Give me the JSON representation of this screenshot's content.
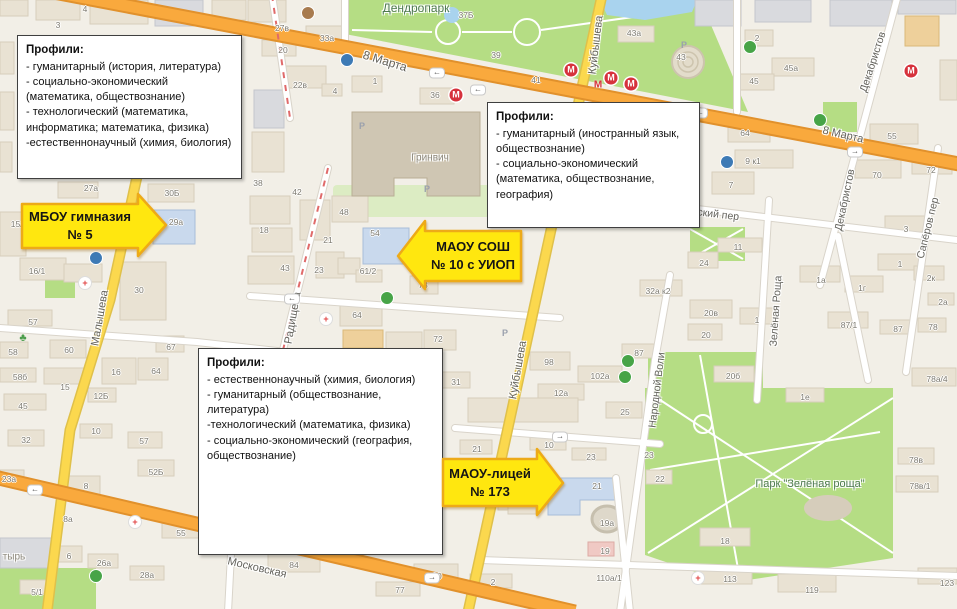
{
  "colors": {
    "map_background": "#f2efe7",
    "road_main": "#f9a93d",
    "road_main_casing": "#e1912c",
    "road_secondary": "#fbd84e",
    "road_secondary_casing": "#dfc04a",
    "road_minor": "#ffffff",
    "road_minor_casing": "#d9d4ca",
    "park_green": "#b5dd84",
    "water_blue": "#a9d3ee",
    "building_fill": "#e9e2d3",
    "building_dark": "#cfc6b3",
    "school_blue": "#c9d9ed",
    "annotation_yellow": "#ffe70f",
    "annotation_border": "#edaa18",
    "callout_border": "#3f3f3f",
    "metro_red": "#d6323c"
  },
  "callouts": [
    {
      "title": "Профили:",
      "items": [
        "- гуманитарный (история, литература)",
        "- социально-экономический (математика, обществознание)",
        "- технологический (математика, информатика; математика, физика)",
        "-естественнонаучный (химия, биология)"
      ]
    },
    {
      "title": "Профили:",
      "items": [
        "- гуманитарный (иностранный язык, обществознание)",
        "- социально-экономический (математика, обществознание, география)"
      ]
    },
    {
      "title": "Профили:",
      "items": [
        "- естественнонаучный  (химия, биология)",
        "- гуманитарный (обществознание, литература)",
        "-технологический (математика, физика)",
        "- социально-экономический (география, обществознание)"
      ]
    }
  ],
  "school_labels": [
    {
      "line1": "МБОУ гимназия",
      "line2": "№ 5",
      "arrow_direction": "right"
    },
    {
      "line1": "МАОУ СОШ",
      "line2": "№ 10 с УИОП",
      "arrow_direction": "left"
    },
    {
      "line1": "МАОУ-лицей",
      "line2": "№ 173",
      "arrow_direction": "right"
    }
  ],
  "map": {
    "street_labels": [
      {
        "t": "8 Марта",
        "x": 385,
        "y": 61,
        "rot": 17,
        "size": 12
      },
      {
        "t": "8 Марта",
        "x": 843,
        "y": 135,
        "rot": 13,
        "size": 11
      },
      {
        "t": "Московская",
        "x": 257,
        "y": 568,
        "rot": 13,
        "size": 11
      },
      {
        "t": "Куйбышева",
        "x": 596,
        "y": 45,
        "rot": -83,
        "size": 11
      },
      {
        "t": "Куйбышева",
        "x": 518,
        "y": 370,
        "rot": -80,
        "size": 11
      },
      {
        "t": "Малышева",
        "x": 100,
        "y": 318,
        "rot": -80,
        "size": 11
      },
      {
        "t": "Радищева",
        "x": 293,
        "y": 318,
        "rot": -80,
        "size": 11
      },
      {
        "t": "Народной Воли",
        "x": 657,
        "y": 390,
        "rot": -83,
        "size": 10.5
      },
      {
        "t": "Зелёная Роща",
        "x": 776,
        "y": 311,
        "rot": -86,
        "size": 10.5
      },
      {
        "t": "Сапёров пер",
        "x": 928,
        "y": 228,
        "rot": -76,
        "size": 10.5
      },
      {
        "t": "Декабристов",
        "x": 873,
        "y": 62,
        "rot": -72,
        "size": 10.5
      },
      {
        "t": "Декабристов",
        "x": 845,
        "y": 200,
        "rot": -78,
        "size": 10.5
      },
      {
        "t": "Университетский пер",
        "x": 688,
        "y": 211,
        "rot": 7,
        "size": 10.5
      }
    ],
    "place_labels": [
      {
        "t": "Дендропарк",
        "x": 416,
        "y": 8,
        "size": 12,
        "k": "park"
      },
      {
        "t": "Парк \"Зелёная роща\"",
        "x": 810,
        "y": 484,
        "size": 11,
        "k": "park"
      },
      {
        "t": "Гринвич",
        "x": 430,
        "y": 158,
        "size": 10,
        "k": "bldg"
      },
      {
        "t": "тырь",
        "x": 14,
        "y": 557,
        "size": 10,
        "k": "bldg"
      }
    ],
    "building_labels": [
      {
        "t": "4",
        "x": 85,
        "y": 9
      },
      {
        "t": "3",
        "x": 58,
        "y": 25
      },
      {
        "t": "27в",
        "x": 282,
        "y": 28
      },
      {
        "t": "33а",
        "x": 327,
        "y": 38
      },
      {
        "t": "20",
        "x": 283,
        "y": 50
      },
      {
        "t": "22в",
        "x": 300,
        "y": 85
      },
      {
        "t": "4",
        "x": 335,
        "y": 91
      },
      {
        "t": "1",
        "x": 375,
        "y": 81
      },
      {
        "t": "36",
        "x": 435,
        "y": 95
      },
      {
        "t": "37Б",
        "x": 466,
        "y": 15
      },
      {
        "t": "39",
        "x": 496,
        "y": 55
      },
      {
        "t": "41",
        "x": 536,
        "y": 80
      },
      {
        "t": "43а",
        "x": 634,
        "y": 33
      },
      {
        "t": "43",
        "x": 681,
        "y": 57
      },
      {
        "t": "2",
        "x": 757,
        "y": 38
      },
      {
        "t": "45а",
        "x": 791,
        "y": 68
      },
      {
        "t": "45",
        "x": 754,
        "y": 81
      },
      {
        "t": "64",
        "x": 745,
        "y": 133
      },
      {
        "t": "55",
        "x": 892,
        "y": 136
      },
      {
        "t": "9 к1",
        "x": 753,
        "y": 161
      },
      {
        "t": "7",
        "x": 731,
        "y": 185
      },
      {
        "t": "70",
        "x": 877,
        "y": 175
      },
      {
        "t": "72",
        "x": 931,
        "y": 170
      },
      {
        "t": "3",
        "x": 906,
        "y": 229
      },
      {
        "t": "1",
        "x": 900,
        "y": 264
      },
      {
        "t": "11",
        "x": 738,
        "y": 247
      },
      {
        "t": "24",
        "x": 704,
        "y": 263
      },
      {
        "t": "32а к2",
        "x": 658,
        "y": 291
      },
      {
        "t": "20в",
        "x": 711,
        "y": 313
      },
      {
        "t": "20",
        "x": 706,
        "y": 335
      },
      {
        "t": "1",
        "x": 757,
        "y": 320
      },
      {
        "t": "1а",
        "x": 821,
        "y": 280
      },
      {
        "t": "1г",
        "x": 862,
        "y": 288
      },
      {
        "t": "87/1",
        "x": 849,
        "y": 325
      },
      {
        "t": "87",
        "x": 898,
        "y": 329
      },
      {
        "t": "78",
        "x": 933,
        "y": 327
      },
      {
        "t": "2к",
        "x": 931,
        "y": 278
      },
      {
        "t": "2а",
        "x": 943,
        "y": 302
      },
      {
        "t": "38",
        "x": 258,
        "y": 183
      },
      {
        "t": "42",
        "x": 297,
        "y": 192
      },
      {
        "t": "48",
        "x": 344,
        "y": 212
      },
      {
        "t": "18",
        "x": 264,
        "y": 230
      },
      {
        "t": "21",
        "x": 328,
        "y": 240
      },
      {
        "t": "43",
        "x": 285,
        "y": 268
      },
      {
        "t": "23",
        "x": 319,
        "y": 270
      },
      {
        "t": "54",
        "x": 375,
        "y": 233
      },
      {
        "t": "61/2",
        "x": 368,
        "y": 271
      },
      {
        "t": "73",
        "x": 423,
        "y": 285
      },
      {
        "t": "64",
        "x": 357,
        "y": 315
      },
      {
        "t": "72",
        "x": 438,
        "y": 339
      },
      {
        "t": "27а",
        "x": 91,
        "y": 188
      },
      {
        "t": "30Б",
        "x": 172,
        "y": 193
      },
      {
        "t": "29а",
        "x": 176,
        "y": 222
      },
      {
        "t": "15/2",
        "x": 19,
        "y": 224
      },
      {
        "t": "16/1",
        "x": 37,
        "y": 271
      },
      {
        "t": "57",
        "x": 33,
        "y": 322
      },
      {
        "t": "58",
        "x": 13,
        "y": 352
      },
      {
        "t": "60",
        "x": 69,
        "y": 350
      },
      {
        "t": "58б",
        "x": 20,
        "y": 377
      },
      {
        "t": "15",
        "x": 65,
        "y": 387
      },
      {
        "t": "45",
        "x": 23,
        "y": 406
      },
      {
        "t": "30",
        "x": 139,
        "y": 290
      },
      {
        "t": "16",
        "x": 116,
        "y": 372
      },
      {
        "t": "12Б",
        "x": 101,
        "y": 396
      },
      {
        "t": "64",
        "x": 156,
        "y": 371
      },
      {
        "t": "67",
        "x": 171,
        "y": 347
      },
      {
        "t": "31",
        "x": 456,
        "y": 382
      },
      {
        "t": "98",
        "x": 549,
        "y": 362
      },
      {
        "t": "102а",
        "x": 600,
        "y": 376
      },
      {
        "t": "12а",
        "x": 561,
        "y": 393
      },
      {
        "t": "25",
        "x": 625,
        "y": 412
      },
      {
        "t": "21",
        "x": 477,
        "y": 449
      },
      {
        "t": "10",
        "x": 549,
        "y": 445
      },
      {
        "t": "23",
        "x": 591,
        "y": 457
      },
      {
        "t": "87",
        "x": 639,
        "y": 353
      },
      {
        "t": "22",
        "x": 660,
        "y": 479
      },
      {
        "t": "23",
        "x": 649,
        "y": 455
      },
      {
        "t": "20б",
        "x": 733,
        "y": 376
      },
      {
        "t": "1е",
        "x": 805,
        "y": 397
      },
      {
        "t": "78а/4",
        "x": 937,
        "y": 379
      },
      {
        "t": "78в",
        "x": 916,
        "y": 460
      },
      {
        "t": "78в/1",
        "x": 920,
        "y": 486
      },
      {
        "t": "18",
        "x": 725,
        "y": 541
      },
      {
        "t": "113",
        "x": 730,
        "y": 579
      },
      {
        "t": "119",
        "x": 812,
        "y": 590
      },
      {
        "t": "123",
        "x": 947,
        "y": 583
      },
      {
        "t": "32",
        "x": 26,
        "y": 440
      },
      {
        "t": "10",
        "x": 96,
        "y": 431
      },
      {
        "t": "57",
        "x": 144,
        "y": 441
      },
      {
        "t": "23а",
        "x": 9,
        "y": 479
      },
      {
        "t": "52Б",
        "x": 156,
        "y": 472
      },
      {
        "t": "8",
        "x": 86,
        "y": 486
      },
      {
        "t": "8а",
        "x": 68,
        "y": 519
      },
      {
        "t": "55",
        "x": 181,
        "y": 533
      },
      {
        "t": "6",
        "x": 69,
        "y": 556
      },
      {
        "t": "26а",
        "x": 104,
        "y": 563
      },
      {
        "t": "28а",
        "x": 147,
        "y": 575
      },
      {
        "t": "5/1",
        "x": 37,
        "y": 592
      },
      {
        "t": "84",
        "x": 294,
        "y": 565
      },
      {
        "t": "90",
        "x": 437,
        "y": 576
      },
      {
        "t": "77",
        "x": 400,
        "y": 590
      },
      {
        "t": "2",
        "x": 493,
        "y": 582
      },
      {
        "t": "21",
        "x": 597,
        "y": 486
      },
      {
        "t": "19а",
        "x": 607,
        "y": 523
      },
      {
        "t": "19",
        "x": 605,
        "y": 551
      },
      {
        "t": "110а/1",
        "x": 609,
        "y": 578
      },
      {
        "t": "6",
        "x": 523,
        "y": 503
      }
    ],
    "metro_icons": [
      {
        "x": 571,
        "y": 70
      },
      {
        "x": 611,
        "y": 78
      },
      {
        "x": 631,
        "y": 84
      },
      {
        "x": 911,
        "y": 71
      },
      {
        "x": 456,
        "y": 95
      }
    ],
    "metro_text": [
      {
        "t": "М",
        "x": 598,
        "y": 85
      }
    ],
    "pois": [
      {
        "k": "medical",
        "x": 85,
        "y": 283
      },
      {
        "k": "medical",
        "x": 135,
        "y": 522
      },
      {
        "k": "medical",
        "x": 698,
        "y": 578
      },
      {
        "k": "medical",
        "x": 326,
        "y": 319
      },
      {
        "k": "shop",
        "x": 387,
        "y": 298
      },
      {
        "k": "shop",
        "x": 625,
        "y": 377
      },
      {
        "k": "shop",
        "x": 628,
        "y": 361
      },
      {
        "k": "shop",
        "x": 96,
        "y": 576
      },
      {
        "k": "shop",
        "x": 820,
        "y": 120
      },
      {
        "k": "cafe",
        "x": 308,
        "y": 13
      },
      {
        "k": "fuel",
        "x": 750,
        "y": 47
      },
      {
        "k": "blue",
        "x": 347,
        "y": 60
      },
      {
        "k": "blue",
        "x": 96,
        "y": 258
      },
      {
        "k": "blue",
        "x": 727,
        "y": 162
      },
      {
        "k": "tree",
        "x": 23,
        "y": 338
      },
      {
        "k": "parking",
        "x": 362,
        "y": 126
      },
      {
        "k": "parking",
        "x": 427,
        "y": 189
      },
      {
        "k": "parking",
        "x": 447,
        "y": 238
      },
      {
        "k": "parking",
        "x": 684,
        "y": 45
      },
      {
        "k": "parking",
        "x": 505,
        "y": 333
      }
    ],
    "traffic_arrows": [
      {
        "g": "←",
        "x": 437,
        "y": 73
      },
      {
        "g": "←",
        "x": 478,
        "y": 90
      },
      {
        "g": "←",
        "x": 700,
        "y": 113
      },
      {
        "g": "→",
        "x": 855,
        "y": 152
      },
      {
        "g": "←",
        "x": 35,
        "y": 490
      },
      {
        "g": "→",
        "x": 432,
        "y": 578
      },
      {
        "g": "→",
        "x": 560,
        "y": 437
      },
      {
        "g": "←",
        "x": 292,
        "y": 299
      }
    ]
  }
}
